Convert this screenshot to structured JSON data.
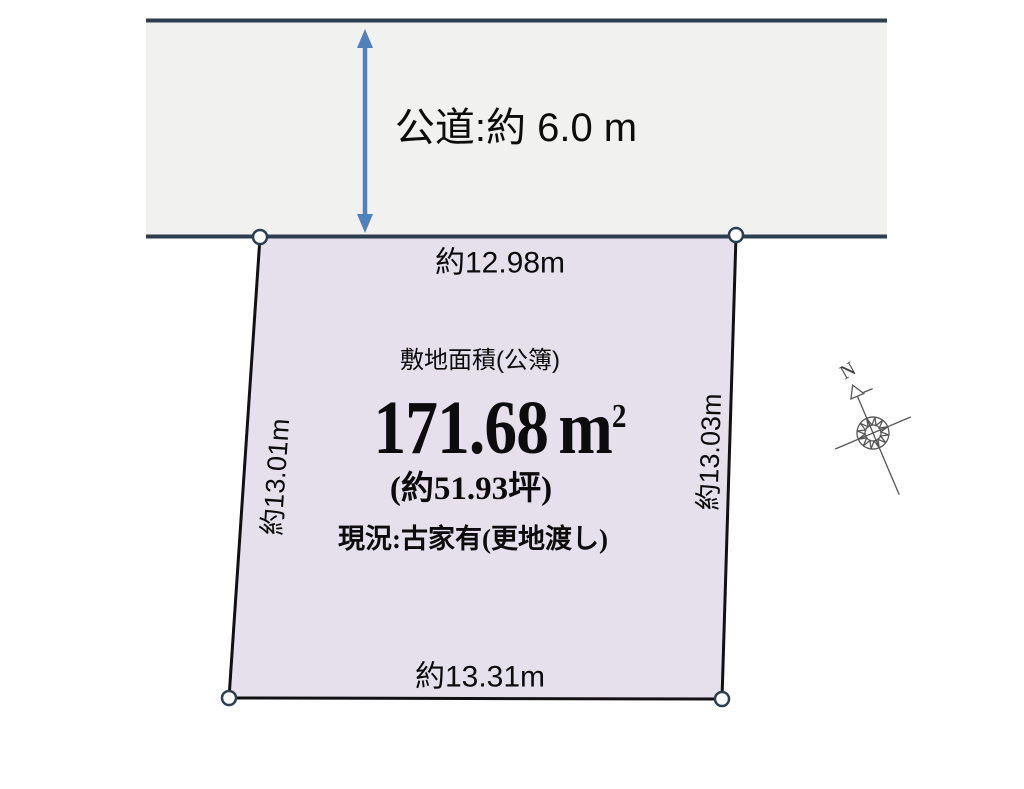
{
  "road": {
    "label": "公道:約 6.0 m"
  },
  "parcel": {
    "area_caption": "敷地面積(公簿)",
    "area_number": "171.68",
    "area_unit": "m",
    "area_exponent": "2",
    "area_tsubo": "(約51.93坪)",
    "status": "現況:古家有(更地渡し)",
    "dim_top": "約12.98m",
    "dim_bottom": "約13.31m",
    "dim_left": "約13.01m",
    "dim_right": "約13.03m"
  },
  "compass": {
    "north": "N"
  },
  "colors": {
    "road_fill": "#f1f1ef",
    "road_line": "#2d3e50",
    "arrow_blue": "#4f81bd",
    "parcel_fill": "#e5e0ec",
    "parcel_border": "#111111",
    "marker_fill": "#ffffff",
    "compass_stroke": "#555555"
  }
}
